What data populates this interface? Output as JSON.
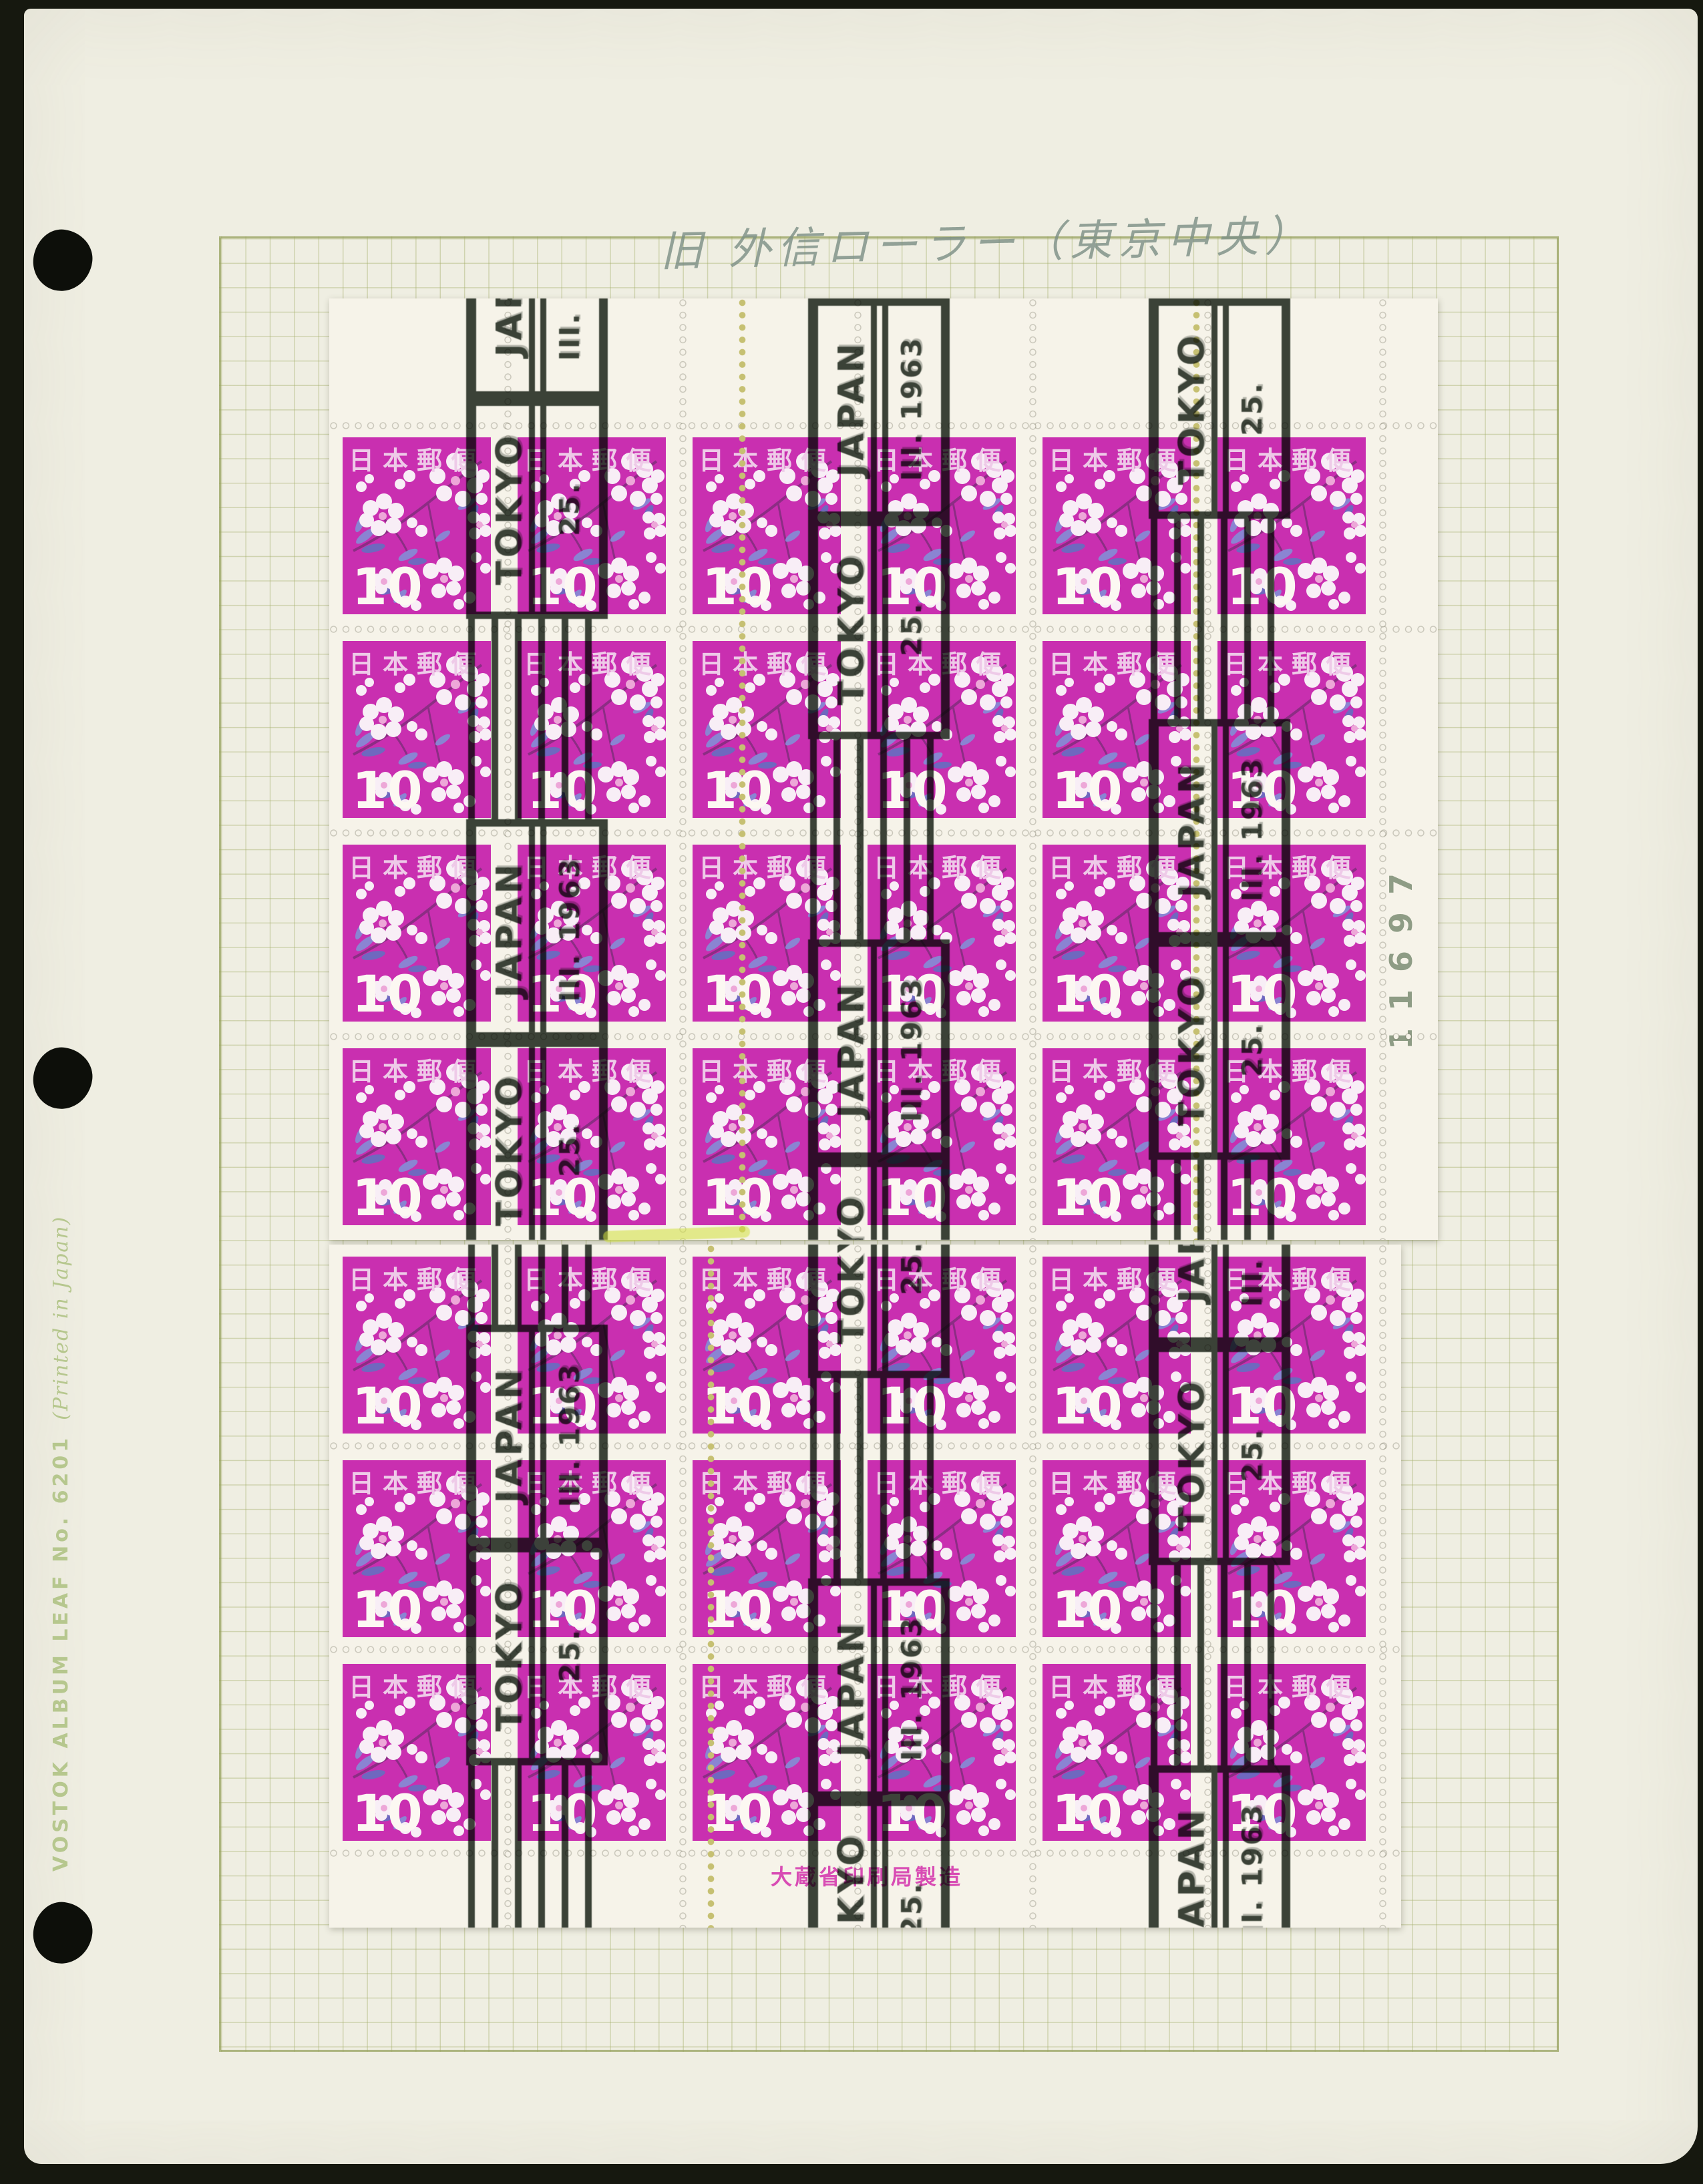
{
  "photo": {
    "background_color": "#16180f",
    "description": "Scanned stamp album page with cancelled stamp blocks"
  },
  "page": {
    "paper_color": "#efeee2",
    "stock_label": "VOSTOK ALBUM LEAF No. 6201",
    "stock_label_suffix": "(Printed in Japan)",
    "stock_label_color": "#b6c78e",
    "handwritten_note": "旧 外信ローラー（東京中央）",
    "handwritten_note_color": "#7c8f85",
    "punch_holes": 3,
    "grid_line_color": "#a8b26e"
  },
  "stamp": {
    "country_text": "日本郵便",
    "denomination": "10",
    "background_color": "#c92fb0",
    "header_color": "#eecae8",
    "flower_white": "#f8eef6",
    "flower_pink": "#eda7d8",
    "leaf_violet": "#8a84d2",
    "leaf_violet_dark": "#6f68bf",
    "branch_color": "#8c2d84"
  },
  "cancellation": {
    "city": "TOKYO",
    "country": "JAPAN",
    "day": "25.",
    "month": "III.",
    "year": "1963",
    "full_text": "TOKYO JAPAN 25. III. 1963",
    "ink_color": "#2c352b",
    "bands": 3
  },
  "sheet": {
    "paper_color": "#f6f3e9",
    "upper_block": {
      "rows": 4,
      "cols": 6,
      "plate_number": "11697"
    },
    "lower_block": {
      "rows": 3,
      "cols": 6,
      "imprint": "大蔵省印刷局製造",
      "imprint_color": "#d84cb4"
    }
  }
}
